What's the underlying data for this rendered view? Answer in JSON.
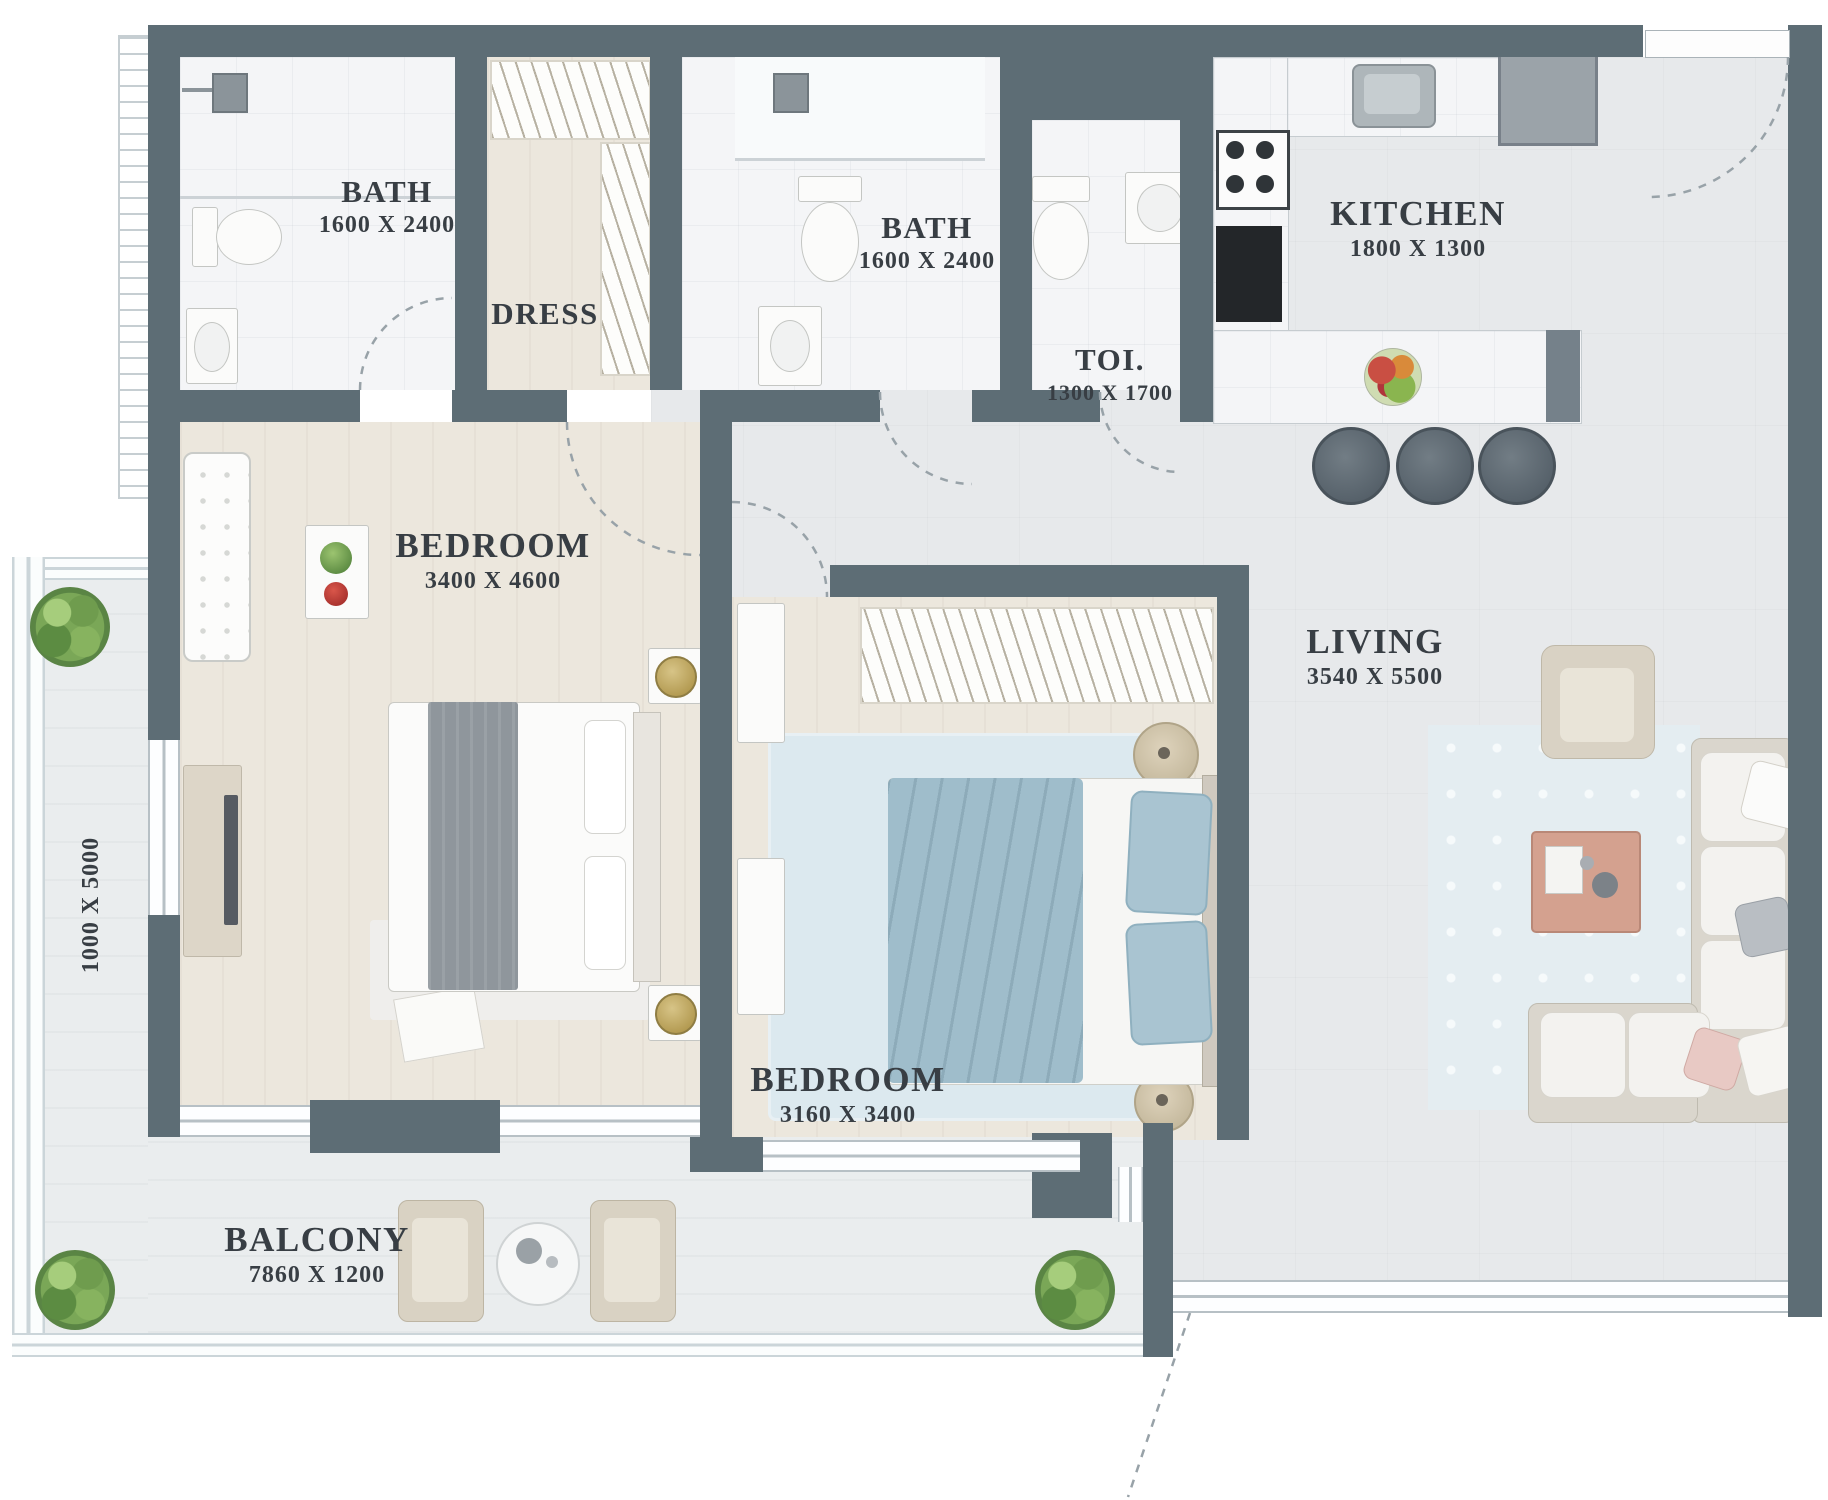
{
  "title": "Apartment Floor Plan",
  "rooms": {
    "bath1": {
      "name": "BATH",
      "dims": "1600 X 2400"
    },
    "dress": {
      "name": "DRESS",
      "dims": ""
    },
    "bath2": {
      "name": "BATH",
      "dims": "1600 X 2400"
    },
    "toilet": {
      "name": "TOI.",
      "dims": "1300 X 1700"
    },
    "kitchen": {
      "name": "KITCHEN",
      "dims": "1800 X 1300"
    },
    "bedroom1": {
      "name": "BEDROOM",
      "dims": "3400 X 4600"
    },
    "living": {
      "name": "LIVING",
      "dims": "3540 X 5500"
    },
    "bedroom2": {
      "name": "BEDROOM",
      "dims": "3160 X 3400"
    },
    "balcony": {
      "name": "BALCONY",
      "dims": "7860 X 1200"
    },
    "side_balcony": {
      "dims": "1000 X 5000"
    }
  },
  "colors": {
    "wall": "#5d6d75",
    "floor_gray": "#e7e9eb",
    "floor_marble": "#f4f5f7",
    "floor_beige": "#ece7dd",
    "balcony_floor": "#eaedee",
    "rug_blue": "#dce9ef",
    "duvet_blue": "#9fbdcb",
    "text": "#383e44"
  }
}
